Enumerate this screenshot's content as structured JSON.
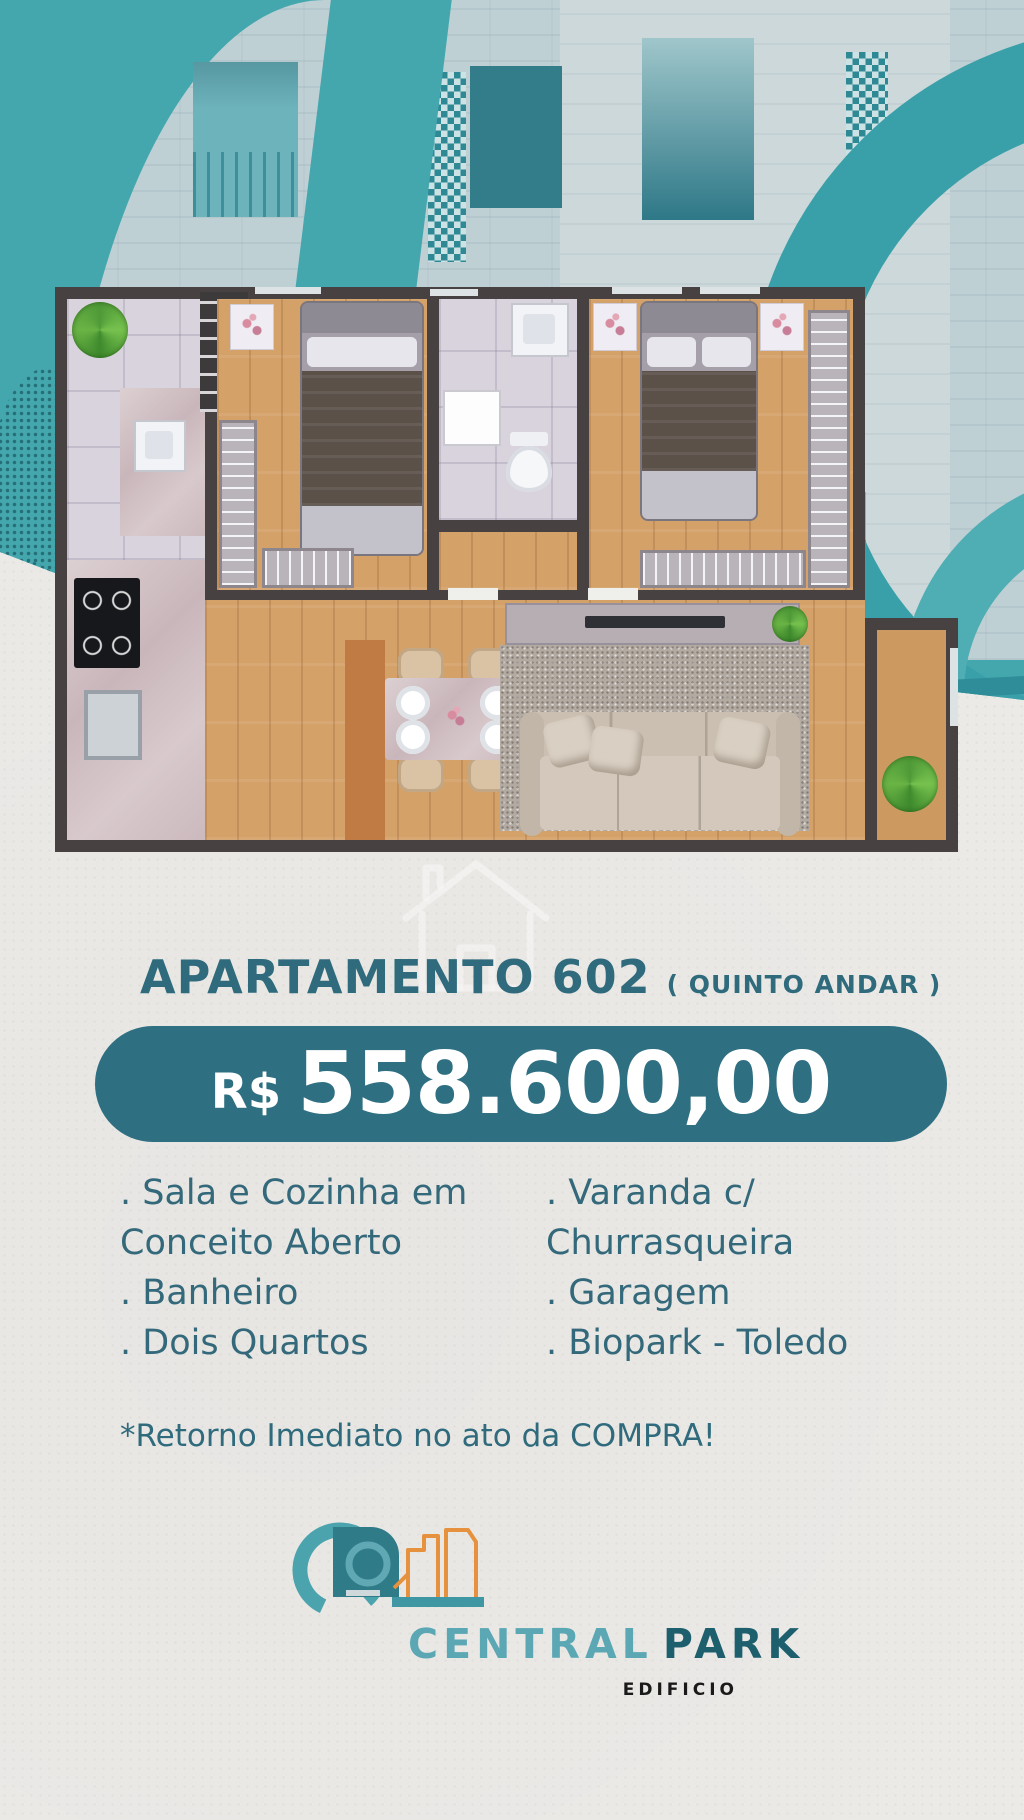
{
  "poster": {
    "title_main": "APARTAMENTO 602",
    "title_sub": "( QUINTO ANDAR )",
    "price_currency": "R$",
    "price_amount": "558.600,00",
    "features_left": [
      ". Sala e Cozinha em Conceito Aberto",
      ". Banheiro",
      ". Dois Quartos"
    ],
    "features_right": [
      ". Varanda c/ Churrasqueira",
      ". Garagem",
      ". Biopark - Toledo"
    ],
    "note": "*Retorno Imediato no ato da COMPRA!",
    "brand_primary": "CENTRAL",
    "brand_secondary": "PARK",
    "brand_subtitle": "EDIFICIO",
    "colors": {
      "hero_teal": "#44a7ae",
      "banner_teal": "#2e6f81",
      "text_teal": "#2f6b7c",
      "logo_orange": "#e5913d",
      "wall_gray": "#474241",
      "wood_floor": "#d4a169",
      "paper": "#eceae7"
    },
    "icons": [
      "house-watermark-icon",
      "brand-logo-icon",
      "plant-icon"
    ]
  }
}
